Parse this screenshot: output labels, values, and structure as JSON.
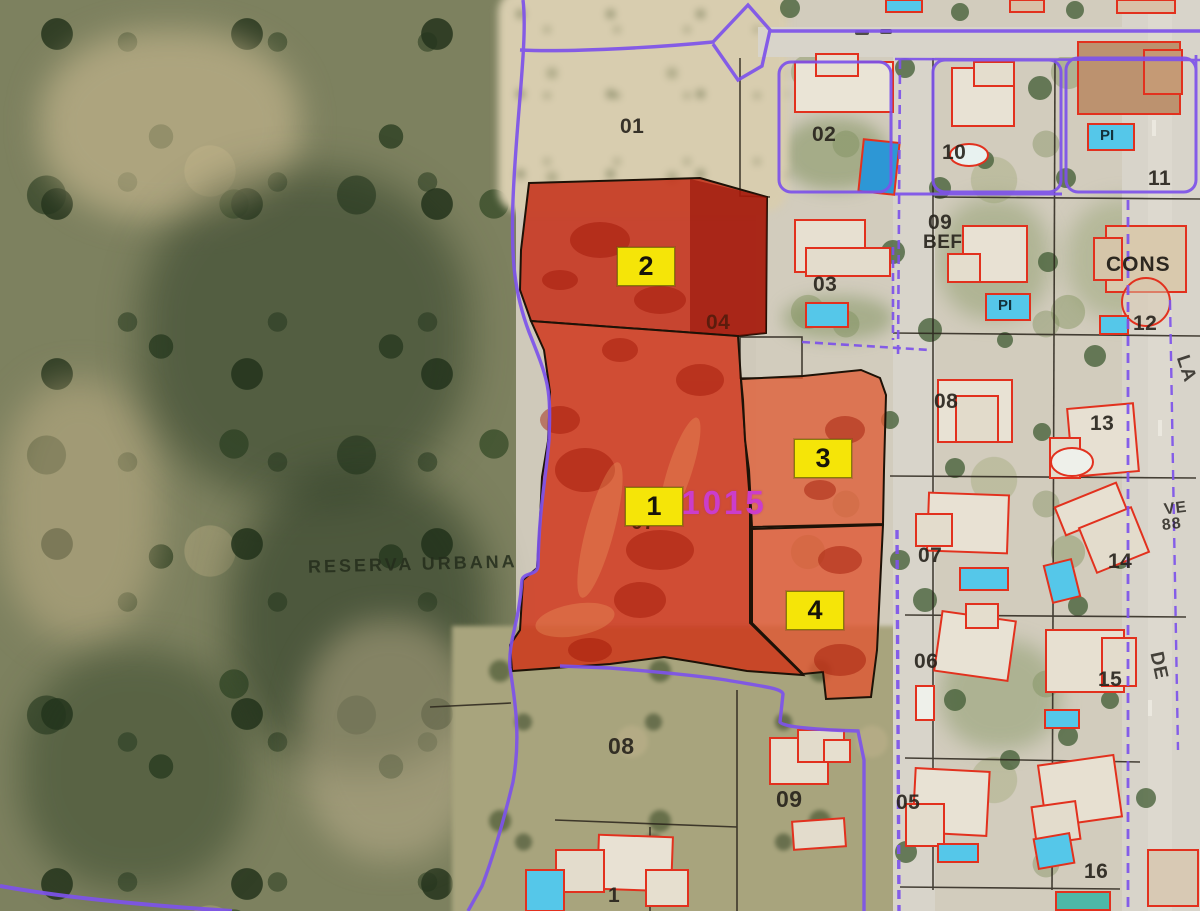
{
  "map": {
    "kind": "aerial-cadastral-map",
    "reserva_label": "RESERVA URBANA",
    "ref_code": "31015"
  },
  "highlight_labels": {
    "h1": "1",
    "h2": "2",
    "h3": "3",
    "h4": "4"
  },
  "parcel_numbers": {
    "n01": "01",
    "n02": "02",
    "n03": "03",
    "n04": "04",
    "n07a": "07",
    "n08a": "08",
    "n09a": "09",
    "n10": "10",
    "n11": "11",
    "n09b": "09",
    "n12": "12",
    "n08b": "08",
    "n13": "13",
    "n07b": "07",
    "n14": "14",
    "n06": "06",
    "n15": "15",
    "n05": "05",
    "n16": "16",
    "n17partial": "1"
  },
  "building_annotations": {
    "cons": "CONS",
    "bef": "BEF",
    "pi_a": "PI",
    "pi_b": "PI"
  },
  "street_labels": {
    "la": "LA",
    "ve": "VE",
    "ve_num": "88",
    "de": "DE"
  },
  "colors": {
    "parcel_highlight_red": "#cd3014",
    "parcel_highlight_orange": "#dd5c36",
    "parcel_label_bg": "#f4e50c",
    "boundary_purple": "#7d52e8",
    "building_outline_red": "#df321f",
    "pool_cyan": "#57c7e8",
    "ref_code_magenta": "#c93ec9"
  }
}
